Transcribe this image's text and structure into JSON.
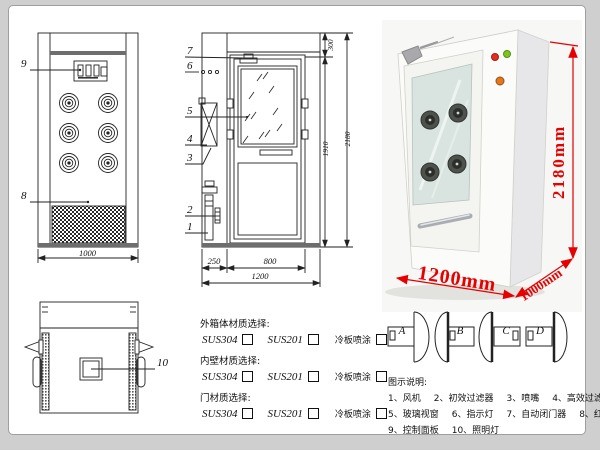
{
  "views": {
    "front": {
      "name": "front view drawing",
      "part_labels": {
        "control_panel": "9",
        "grille": "8"
      },
      "width_dim": "1000"
    },
    "side": {
      "name": "side/door view drawing",
      "part_labels": [
        "7",
        "6",
        "5",
        "4",
        "3",
        "2",
        "1"
      ],
      "dims": {
        "top": "300",
        "door_height": "1910",
        "total_height": "2180",
        "left_section": "250",
        "door_width": "800",
        "total_width": "1200"
      }
    },
    "top": {
      "name": "top view drawing",
      "part_label": "10"
    }
  },
  "photo": {
    "dims": {
      "height": "2180mm",
      "width": "1200mm",
      "depth": "1000mm"
    },
    "colors": {
      "dim_red": "#e60000",
      "indicator_red": "#e03020",
      "indicator_green": "#7cc520",
      "indicator_amber": "#e07820",
      "cabinet_white": "#fbfbf9",
      "glass_green": "#d9e4e0"
    }
  },
  "door_swing": {
    "options": [
      "A",
      "B",
      "C",
      "D"
    ]
  },
  "materials": {
    "sections": [
      {
        "title": "外箱体材质选择:",
        "options": [
          {
            "label": "SUS304"
          },
          {
            "label": "SUS201"
          },
          {
            "label": "冷板喷涂"
          }
        ]
      },
      {
        "title": "内壁材质选择:",
        "options": [
          {
            "label": "SUS304"
          },
          {
            "label": "SUS201"
          },
          {
            "label": "冷板喷涂"
          }
        ]
      },
      {
        "title": "门材质选择:",
        "options": [
          {
            "label": "SUS304"
          },
          {
            "label": "SUS201"
          },
          {
            "label": "冷板喷涂"
          }
        ]
      }
    ]
  },
  "legend": {
    "title": "图示说明:",
    "items": [
      "1、风机",
      "2、初效过滤器",
      "3、喷嘴",
      "4、高效过滤器",
      "5、玻璃视窗",
      "6、指示灯",
      "7、自动闭门器",
      "8、红外线感应器",
      "9、控制面板",
      "10、照明灯"
    ]
  }
}
